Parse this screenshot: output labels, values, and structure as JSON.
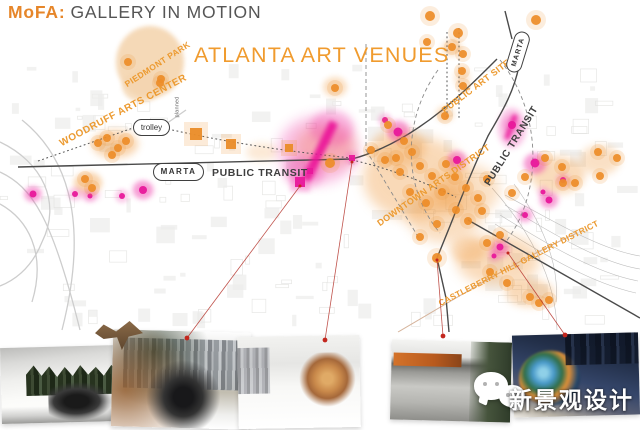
{
  "title": {
    "brand": "MoFA:",
    "rest": "GALLERY IN MOTION"
  },
  "watermark": {
    "text": "新景观设计",
    "icon": "wechat-icon"
  },
  "map": {
    "colors": {
      "orange": "#ed8d29",
      "orange_text": "#ec9a30",
      "heading": "#f09b2e",
      "magenta": "#e8189b",
      "pink_halo": "#ee35a8",
      "road": "#4a4a4a",
      "leader_red": "#b5342c",
      "tip_red": "#c3271e",
      "park": "#f4d5b0"
    },
    "labels": [
      {
        "id": "atlanta-art-venues",
        "text": "ATLANTA ART VENUES",
        "x": 194,
        "y": 45,
        "rot": 0,
        "size": 21.5,
        "color": "heading",
        "weight": 400,
        "ls": 1.2
      },
      {
        "id": "piedmont-park",
        "text": "PIEDMONT PARK",
        "x": 128,
        "y": 80,
        "rot": -33,
        "size": 8.5,
        "color": "orange_text",
        "weight": 700,
        "ls": 0.4
      },
      {
        "id": "woodruff-arts-center",
        "text": "WOODRUFF ARTS CENTER",
        "x": 63,
        "y": 139,
        "rot": -28,
        "size": 10,
        "color": "orange_text",
        "weight": 700,
        "ls": 0.5
      },
      {
        "id": "public-art-sites",
        "text": "PUBLIC ART SITES",
        "x": 446,
        "y": 106,
        "rot": -37,
        "size": 9,
        "color": "orange_text",
        "weight": 700,
        "ls": 0.4
      },
      {
        "id": "downtown-arts-district",
        "text": "DOWNTOWN ARTS DISTRICT",
        "x": 381,
        "y": 219,
        "rot": -35,
        "size": 9,
        "color": "orange_text",
        "weight": 700,
        "ls": 0.4
      },
      {
        "id": "castleberry-hill-gallery-district",
        "text": "CASTLEBERRY HILL GALLERY DISTRICT",
        "x": 441,
        "y": 299,
        "rot": -27,
        "size": 8.5,
        "color": "orange_text",
        "weight": 700,
        "ls": 0.3
      },
      {
        "id": "public-transit-left",
        "text": "PUBLIC TRANSIT",
        "x": 212,
        "y": 168,
        "rot": 0,
        "size": 10.5,
        "color": "dark",
        "weight": 700,
        "ls": 0.6
      },
      {
        "id": "public-transit-right",
        "text": "PUBLIC TRANSIT",
        "x": 492,
        "y": 178,
        "rot": -58,
        "size": 10,
        "color": "dark",
        "weight": 700,
        "ls": 0.6
      },
      {
        "id": "planned",
        "text": "planned",
        "x": 181,
        "y": 112,
        "rot": -90,
        "size": 5.5,
        "color": "gray",
        "weight": 400,
        "ls": 0.2
      }
    ],
    "bubbles": [
      {
        "id": "trolley",
        "text": "trolley",
        "x": 133,
        "y": 119,
        "w": 35,
        "h": 15,
        "rot": 0,
        "size": 8,
        "weight": 400,
        "ls": 0
      },
      {
        "id": "marta-left",
        "text": "MARTA",
        "x": 153,
        "y": 163,
        "w": 49,
        "h": 16,
        "rot": 0,
        "size": 8,
        "weight": 700,
        "ls": 1.5
      },
      {
        "id": "marta-top",
        "text": "MARTA",
        "x": 497,
        "y": 44,
        "w": 40,
        "h": 14,
        "rot": -73,
        "size": 7,
        "weight": 700,
        "ls": 1
      }
    ],
    "heat_blobs": [
      [
        150,
        62,
        34,
        36,
        0.9,
        "park"
      ],
      [
        142,
        86,
        20,
        16,
        0.8,
        "park"
      ],
      [
        115,
        144,
        23,
        14,
        0.4,
        "o"
      ],
      [
        88,
        183,
        14,
        11,
        0.4,
        "o"
      ],
      [
        325,
        147,
        30,
        22,
        0.33,
        "o"
      ],
      [
        262,
        152,
        16,
        9,
        0.2,
        "o"
      ],
      [
        335,
        87,
        12,
        10,
        0.3,
        "o"
      ],
      [
        415,
        178,
        52,
        42,
        0.35,
        "o"
      ],
      [
        445,
        215,
        38,
        28,
        0.3,
        "o"
      ],
      [
        398,
        148,
        28,
        20,
        0.28,
        "o"
      ],
      [
        467,
        190,
        33,
        26,
        0.28,
        "o"
      ],
      [
        558,
        175,
        27,
        19,
        0.33,
        "o"
      ],
      [
        600,
        160,
        20,
        15,
        0.28,
        "o"
      ],
      [
        498,
        260,
        42,
        26,
        0.33,
        "o"
      ],
      [
        530,
        293,
        24,
        14,
        0.33,
        "o"
      ],
      [
        468,
        250,
        18,
        13,
        0.28,
        "o"
      ],
      [
        452,
        48,
        10,
        8,
        0.3,
        "o"
      ],
      [
        462,
        78,
        8,
        10,
        0.22,
        "o"
      ],
      [
        445,
        114,
        9,
        8,
        0.28,
        "o"
      ],
      [
        318,
        150,
        40,
        34,
        0.3,
        "p"
      ],
      [
        332,
        128,
        22,
        18,
        0.3,
        "p"
      ],
      [
        304,
        172,
        20,
        16,
        0.3,
        "p"
      ],
      [
        512,
        128,
        14,
        20,
        0.3,
        "p"
      ],
      [
        535,
        164,
        12,
        10,
        0.3,
        "p"
      ],
      [
        143,
        190,
        11,
        9,
        0.3,
        "p"
      ],
      [
        33,
        194,
        9,
        7,
        0.3,
        "p"
      ],
      [
        90,
        195,
        10,
        6,
        0.25,
        "p"
      ],
      [
        398,
        130,
        12,
        10,
        0.3,
        "p"
      ],
      [
        457,
        160,
        10,
        8,
        0.28,
        "p"
      ],
      [
        549,
        200,
        10,
        8,
        0.28,
        "p"
      ],
      [
        525,
        215,
        8,
        7,
        0.25,
        "p"
      ],
      [
        500,
        250,
        10,
        8,
        0.28,
        "p"
      ]
    ],
    "orange_dots": [
      [
        128,
        62
      ],
      [
        161,
        79
      ],
      [
        160,
        83
      ],
      [
        107,
        138
      ],
      [
        118,
        148
      ],
      [
        126,
        141
      ],
      [
        112,
        155
      ],
      [
        98,
        143
      ],
      [
        85,
        179
      ],
      [
        92,
        188
      ],
      [
        330,
        163,
        5
      ],
      [
        335,
        88
      ],
      [
        371,
        150
      ],
      [
        385,
        160
      ],
      [
        388,
        125
      ],
      [
        396,
        158
      ],
      [
        400,
        172
      ],
      [
        404,
        141
      ],
      [
        410,
        192
      ],
      [
        412,
        152
      ],
      [
        420,
        166
      ],
      [
        420,
        237
      ],
      [
        426,
        203
      ],
      [
        432,
        176
      ],
      [
        437,
        224
      ],
      [
        437,
        258,
        5
      ],
      [
        442,
        192
      ],
      [
        446,
        164
      ],
      [
        455,
        177
      ],
      [
        456,
        210
      ],
      [
        466,
        188
      ],
      [
        468,
        221
      ],
      [
        478,
        198
      ],
      [
        482,
        211
      ],
      [
        487,
        179
      ],
      [
        512,
        193
      ],
      [
        525,
        177
      ],
      [
        545,
        158
      ],
      [
        562,
        167
      ],
      [
        563,
        183
      ],
      [
        575,
        183
      ],
      [
        598,
        152
      ],
      [
        600,
        176
      ],
      [
        617,
        158
      ],
      [
        430,
        16,
        5
      ],
      [
        458,
        33,
        5
      ],
      [
        536,
        20,
        5
      ],
      [
        427,
        42
      ],
      [
        452,
        47
      ],
      [
        463,
        54
      ],
      [
        462,
        71
      ],
      [
        463,
        86
      ],
      [
        445,
        116
      ],
      [
        487,
        243
      ],
      [
        500,
        235
      ],
      [
        490,
        272
      ],
      [
        507,
        283
      ],
      [
        530,
        297
      ],
      [
        539,
        303
      ],
      [
        549,
        300
      ]
    ],
    "orange_squares": [
      [
        196,
        134,
        12
      ],
      [
        231,
        144,
        10
      ],
      [
        289,
        148,
        8
      ]
    ],
    "pink_squares": [
      [
        300,
        182,
        10
      ],
      [
        310,
        171,
        6
      ],
      [
        352,
        158,
        6
      ]
    ],
    "pink_dots": [
      [
        33,
        194,
        3.5
      ],
      [
        75,
        194,
        3
      ],
      [
        90,
        196,
        2.5
      ],
      [
        122,
        196,
        3
      ],
      [
        143,
        190,
        4
      ],
      [
        385,
        120,
        3
      ],
      [
        398,
        132,
        4.5
      ],
      [
        457,
        160,
        4
      ],
      [
        512,
        125,
        4
      ],
      [
        535,
        163,
        4.5
      ],
      [
        563,
        180,
        3
      ],
      [
        549,
        200,
        3.5
      ],
      [
        543,
        192,
        2.5
      ],
      [
        525,
        215,
        3
      ],
      [
        500,
        247,
        3.5
      ],
      [
        494,
        256,
        2.5
      ]
    ],
    "pink_streaks": [
      {
        "x": 320,
        "y": 151,
        "w": 9,
        "h": 64,
        "rot": 26
      },
      {
        "x": 511,
        "y": 127,
        "w": 5,
        "h": 26,
        "rot": 20
      }
    ],
    "roads_solid": [
      "M18,167 L352,159",
      "M505,11 L512,39",
      "M519,66 C513,96 498,118 488,136 C473,168 461,198 450,226 L437,258 L446,298 L449,332",
      "M352,159 C386,150 416,131 441,111 C461,95 481,75 497,59",
      "M468,220 L640,318"
    ],
    "roads_dotted": [
      "M38,161 L133,128",
      "M168,129 C225,142 290,152 352,158",
      "M352,160 C392,169 426,183 456,197",
      "M447,32 L447,120",
      "M459,28 L459,118"
    ],
    "roads_dashed": [
      "M366,44 L366,150",
      "M366,150 L420,240",
      "M438,70 C402,120 402,188 440,233",
      "M500,60 C543,114 543,194 505,243"
    ],
    "roads_decor": [
      "M0,142 C42,162 62,202 42,242 C30,272 10,282 0,286",
      "M0,172 C32,187 52,217 80,330",
      "M22,120 C62,152 92,212 62,330",
      "M0,204 C27,219 47,252 32,302",
      "M163,126 L186,110"
    ],
    "roads_rail": [
      "M505,195 C560,225 602,250 640,256",
      "M505,205 C556,236 602,263 640,269",
      "M500,215 C550,246 596,273 638,281",
      "M495,224 C546,256 591,283 636,293",
      "M492,188 C528,228 556,278 557,330",
      "M514,184 C540,220 560,262 556,302"
    ],
    "road_brown": "M398,332 C468,291 520,259 577,233",
    "leader_lines": [
      {
        "x1": 300,
        "y1": 186,
        "x2": 187,
        "y2": 338
      },
      {
        "x1": 352,
        "y1": 162,
        "x2": 325,
        "y2": 340
      },
      {
        "x1": 437,
        "y1": 260,
        "x2": 443,
        "y2": 336
      },
      {
        "x1": 508,
        "y1": 253,
        "x2": 565,
        "y2": 335
      }
    ]
  },
  "photos": [
    {
      "id": "photo-1"
    },
    {
      "id": "photo-2"
    },
    {
      "id": "photo-3"
    },
    {
      "id": "photo-4"
    },
    {
      "id": "photo-5"
    }
  ]
}
